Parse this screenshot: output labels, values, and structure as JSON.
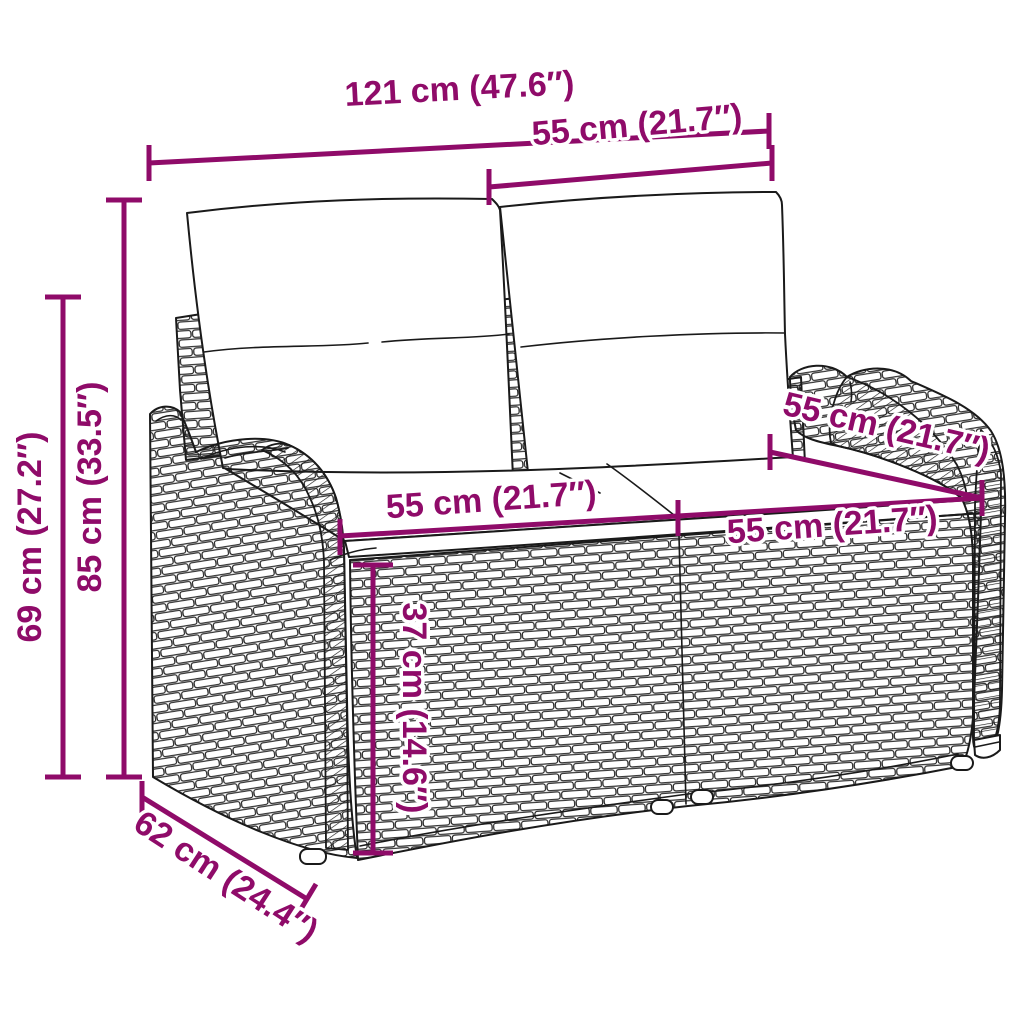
{
  "figure": {
    "subject": "Poly rattan two-seater garden bench with back and seat cushions",
    "style": "black outline product drawing with magenta dimension lines",
    "background": "#FFFFFF"
  },
  "colors": {
    "dimension_magenta": "#8F0B69",
    "line_art_black": "#1A1A1A"
  },
  "dimensions": {
    "overall_width": {
      "label": "121 cm (47.6″)"
    },
    "section_width": {
      "label": "55 cm (21.7″)"
    },
    "overall_height": {
      "label": "85 cm (33.5″)"
    },
    "frame_height": {
      "label": "69 cm (27.2″)"
    },
    "seat_width_left": {
      "label": "55 cm (21.7″)"
    },
    "seat_width_right": {
      "label": "55 cm (21.7″)"
    },
    "seat_depth": {
      "label": "55 cm (21.7″)"
    },
    "seat_height": {
      "label": "37 cm (14.6″)"
    },
    "overall_depth": {
      "label": "62 cm (24.4″)"
    }
  }
}
